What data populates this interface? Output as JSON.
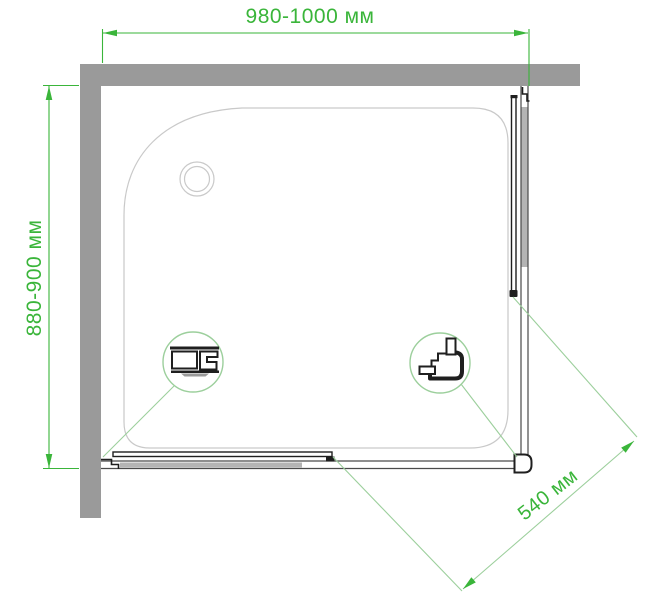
{
  "diagram": {
    "kind": "shower-enclosure-installation-drawing-top-view",
    "dimension_labels": {
      "top_width": "980-1000 мм",
      "left_height": "880-900 мм",
      "diagonal_door": "540 мм"
    },
    "colors": {
      "dimension_green": "#3ab53a",
      "light_green": "#9ccf9c",
      "wall_gray": "#9a9a9a",
      "tray_outline_gray": "#c9c9c9",
      "profile_black": "#1f1f1f",
      "door_panel_gray": "#b4b4b4",
      "rail_gray": "#4a4a4a",
      "background": "#ffffff"
    }
  }
}
